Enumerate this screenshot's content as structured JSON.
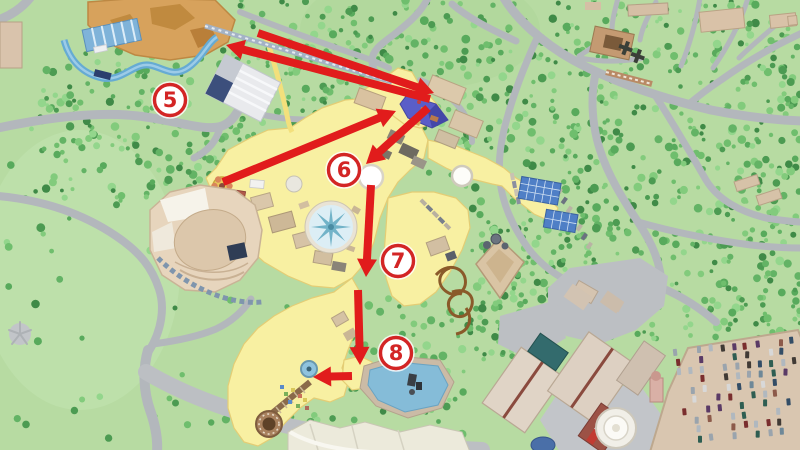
{
  "overlay": {
    "arrow_color": "#e11c1c",
    "marker_style": {
      "fill": "#ffffff",
      "ring": "#d32525",
      "text": "#d32525"
    },
    "markers": [
      {
        "label": "5",
        "x": 170,
        "y": 100
      },
      {
        "label": "6",
        "x": 344,
        "y": 170
      },
      {
        "label": "7",
        "x": 398,
        "y": 261
      },
      {
        "label": "8",
        "x": 396,
        "y": 353
      }
    ],
    "arrows": [
      {
        "name": "blue-building-to-waterride",
        "x1": 430,
        "y1": 99,
        "x2": 226,
        "y2": 45
      },
      {
        "name": "waterride-to-blue-building",
        "x1": 258,
        "y1": 33,
        "x2": 434,
        "y2": 93
      },
      {
        "name": "plaza-to-blue-building",
        "x1": 223,
        "y1": 182,
        "x2": 396,
        "y2": 111
      },
      {
        "name": "blue-building-to-circle",
        "x1": 428,
        "y1": 108,
        "x2": 366,
        "y2": 164
      },
      {
        "name": "six-to-seven",
        "x1": 371,
        "y1": 185,
        "x2": 366,
        "y2": 277
      },
      {
        "name": "seven-to-eight",
        "x1": 358,
        "y1": 290,
        "x2": 360,
        "y2": 365
      },
      {
        "name": "eight-to-fountain",
        "x1": 352,
        "y1": 376,
        "x2": 313,
        "y2": 377
      }
    ]
  }
}
